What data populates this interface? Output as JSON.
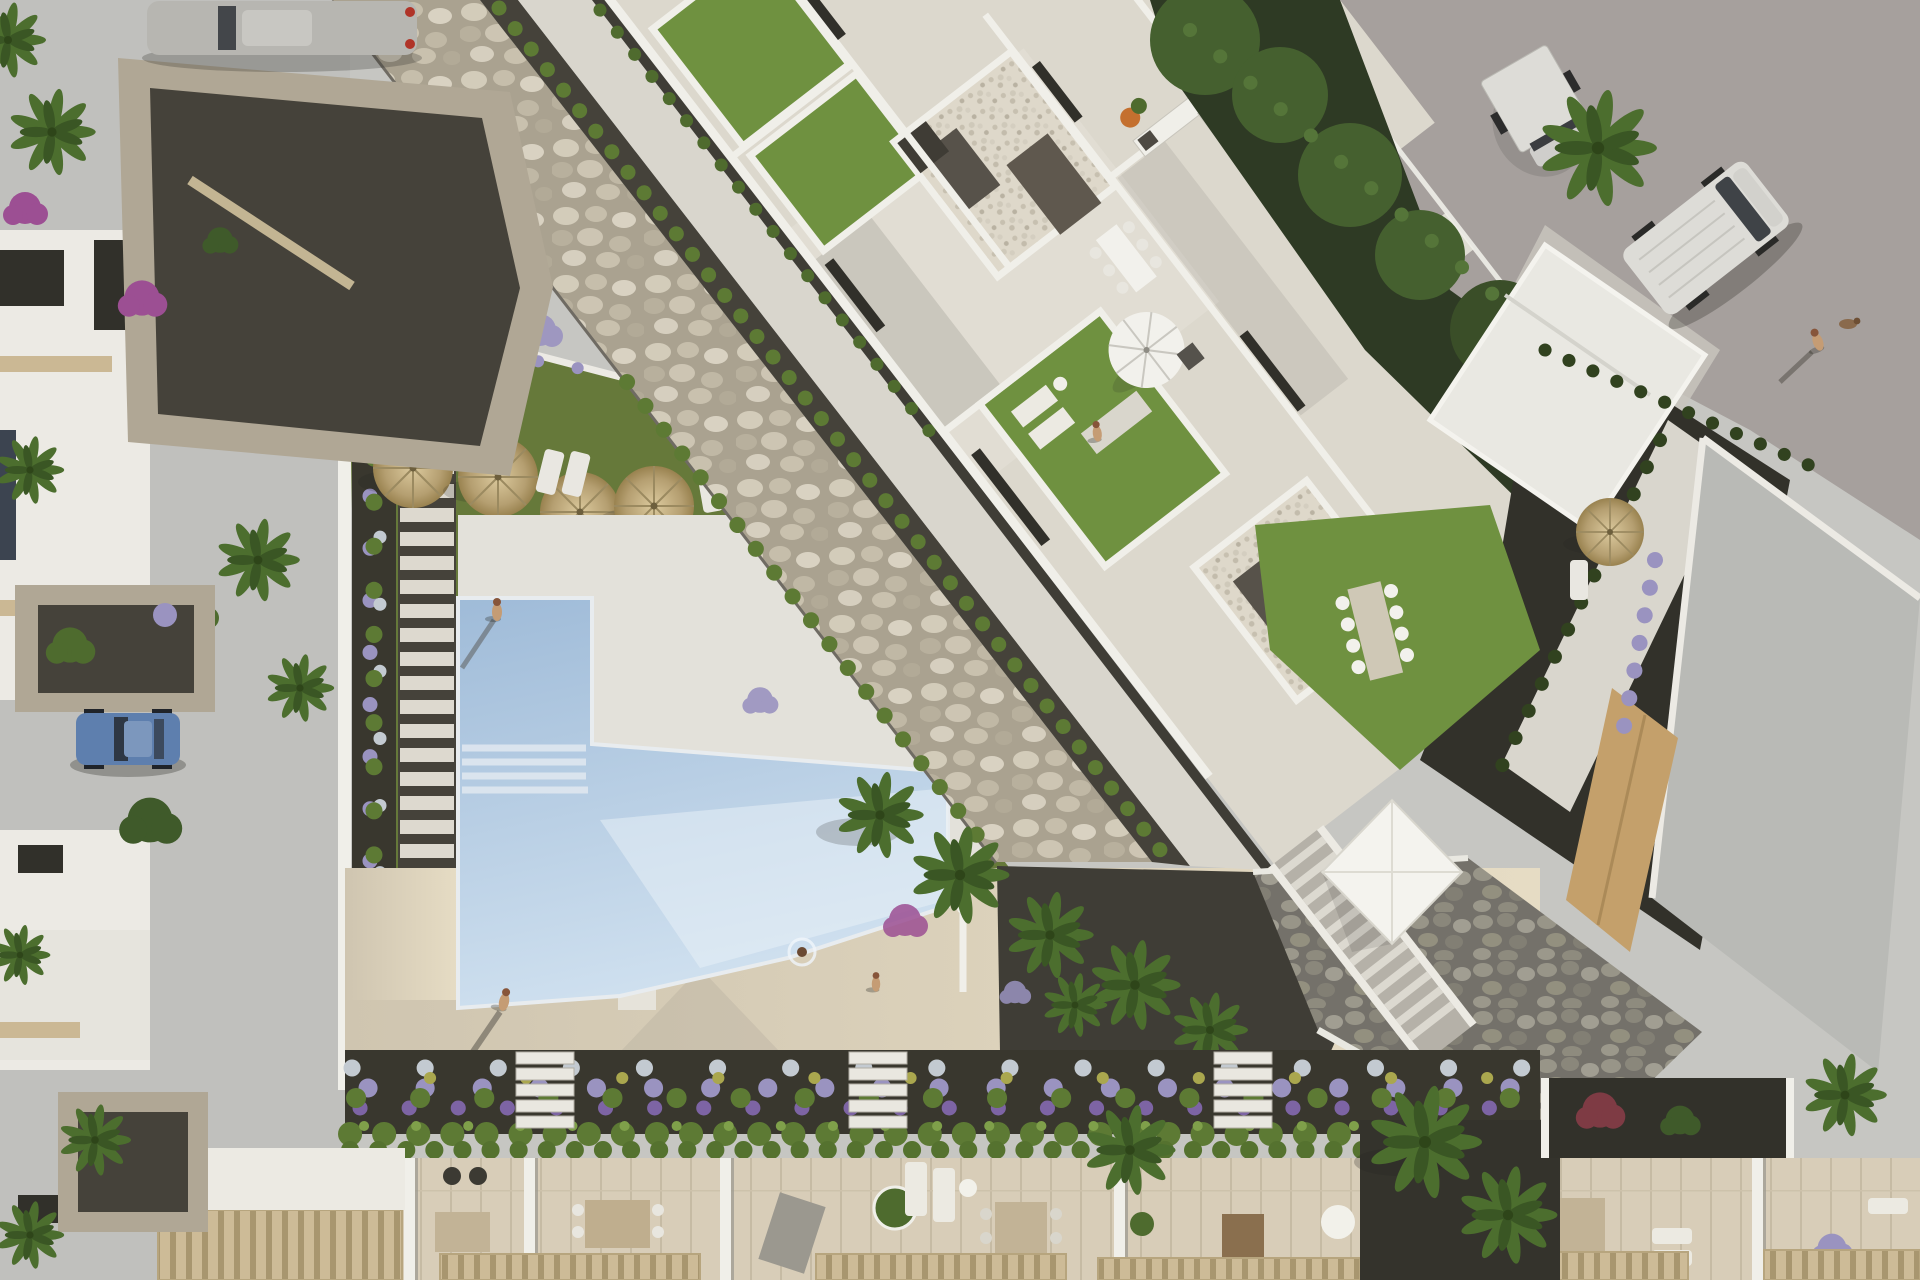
{
  "scene": {
    "title": "Aerial top-down 3D render of a modern white residential complex with communal garden and swimming pool",
    "type": "architectural-render-aerial",
    "palette": {
      "pavement": "#c6c6c2",
      "pavementShade": "#b7b9b7",
      "road": "#a6a09d",
      "rockBase": "#aaa290",
      "stoneWallBase": "#74716a",
      "gravelDark": "#45423a",
      "soilDark": "#39372e",
      "grass": "#66793a",
      "lawn": "#6f9140",
      "hedge": "#5d7a34",
      "palmGreen": "#4c6e2e",
      "palmDark": "#3a5624",
      "deckBeigeA": "#cfc5b0",
      "deckBeigeB": "#e6dcc4",
      "wallWhite": "#f0efe9",
      "floorPale": "#dcd8cd",
      "woodTerrace": "#d8cdb8",
      "pergolaSlat": "#cdbb97",
      "umbrellaWhite": "#f2f1ec",
      "roofGray": "#b9bab6",
      "treeBandDark": "#2e3a24",
      "treeBlob": "#45602f",
      "flowerPurple": "#7d64a4",
      "flowerLavender": "#9a93c0",
      "flowerWhite": "#c3cad1",
      "flowerYellow": "#aaa74e",
      "flowerMagenta": "#9c4f93",
      "flowerOrange": "#c4702f",
      "carBlue": "#5e7fae",
      "carSilver": "#b7b6b1",
      "vanWhite": "#dddcd7",
      "skin": "#c59c74",
      "waterTop": "#9fbbd8",
      "waterBottom": "#cfe0ef"
    },
    "objects": {
      "swimming_pool": {
        "shape": "L-shaped",
        "features": [
          "corner steps",
          "swimmer",
          "sun glare"
        ]
      },
      "straw_parasols": 7,
      "white_parasol": 1,
      "white_canopy_tent": 1,
      "vehicles": [
        {
          "type": "car",
          "color": "blue",
          "location": "left street parking"
        },
        {
          "type": "car",
          "color": "silver",
          "location": "top-left street"
        },
        {
          "type": "van",
          "color": "white",
          "location": "top-right road"
        },
        {
          "type": "trailer",
          "color": "white",
          "location": "top road"
        }
      ],
      "people": [
        "standing on pool deck",
        "walking on beige deck",
        "walking near steps",
        "swimming in pool",
        "walking dog on road",
        "on apartment lawn"
      ],
      "landscape": [
        "diagonal dry river rock bed",
        "hedge rows",
        "palm trees",
        "lavender and flower beds",
        "communal lawn",
        "stone retaining wall with white staircase",
        "stepping-stone path"
      ],
      "buildings": [
        "central white apartment complex with roof terraces and lawns",
        "row of townhouse terraces at bottom with pergolas",
        "white townhouses along left street",
        "villa with gray roof at right"
      ]
    }
  }
}
